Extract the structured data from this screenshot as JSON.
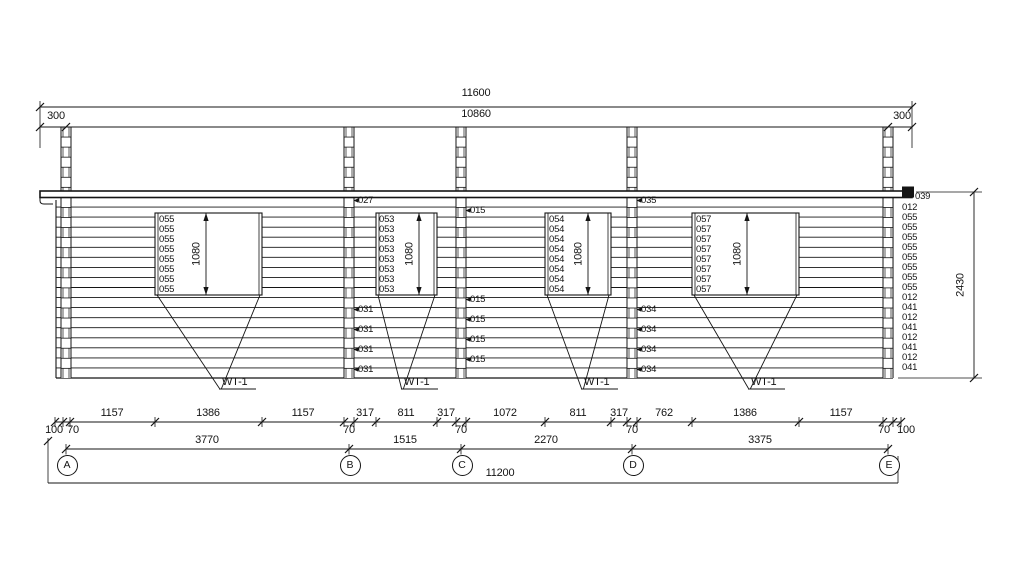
{
  "drawing": {
    "dims_top": {
      "total": "11600",
      "inner": "10860",
      "left_offset": "300",
      "right_offset": "300"
    },
    "dim_right": {
      "height": "2430"
    },
    "grid_axes": [
      "A",
      "B",
      "C",
      "D",
      "E"
    ],
    "windows": [
      {
        "tag": "WT-1",
        "height_dim": "1080",
        "log_labels": [
          "055",
          "055",
          "055",
          "055",
          "055",
          "055",
          "055",
          "055"
        ]
      },
      {
        "tag": "WT-1",
        "height_dim": "1080",
        "log_labels": [
          "053",
          "053",
          "053",
          "053",
          "053",
          "053",
          "053",
          "053"
        ]
      },
      {
        "tag": "WT-1",
        "height_dim": "1080",
        "log_labels": [
          "054",
          "054",
          "054",
          "054",
          "054",
          "054",
          "054",
          "054"
        ]
      },
      {
        "tag": "WT-1",
        "height_dim": "1080",
        "log_labels": [
          "057",
          "057",
          "057",
          "057",
          "057",
          "057",
          "057",
          "057"
        ]
      }
    ],
    "post_labels": {
      "b": {
        "top": "027",
        "lower": [
          "031",
          "031",
          "031",
          "031"
        ]
      },
      "c": {
        "top": "015",
        "lower": [
          "015",
          "015",
          "015",
          "015"
        ]
      },
      "d": {
        "top": "035",
        "lower": [
          "034",
          "034",
          "034",
          "034"
        ]
      }
    },
    "right_edge_labels": [
      "039",
      "012",
      "055",
      "055",
      "055",
      "055",
      "055",
      "055",
      "055",
      "055",
      "012",
      "041",
      "012",
      "041",
      "012",
      "041",
      "012",
      "041"
    ],
    "dims_bottom": {
      "segments": [
        "1157",
        "1386",
        "1157",
        "317",
        "811",
        "317",
        "1072",
        "811",
        "317",
        "762",
        "1386",
        "1157"
      ],
      "small_below": [
        "100",
        "70",
        "70",
        "70",
        "70",
        "70",
        "100"
      ],
      "spans": [
        "3770",
        "1515",
        "2270",
        "3375"
      ],
      "total": "11200"
    }
  }
}
